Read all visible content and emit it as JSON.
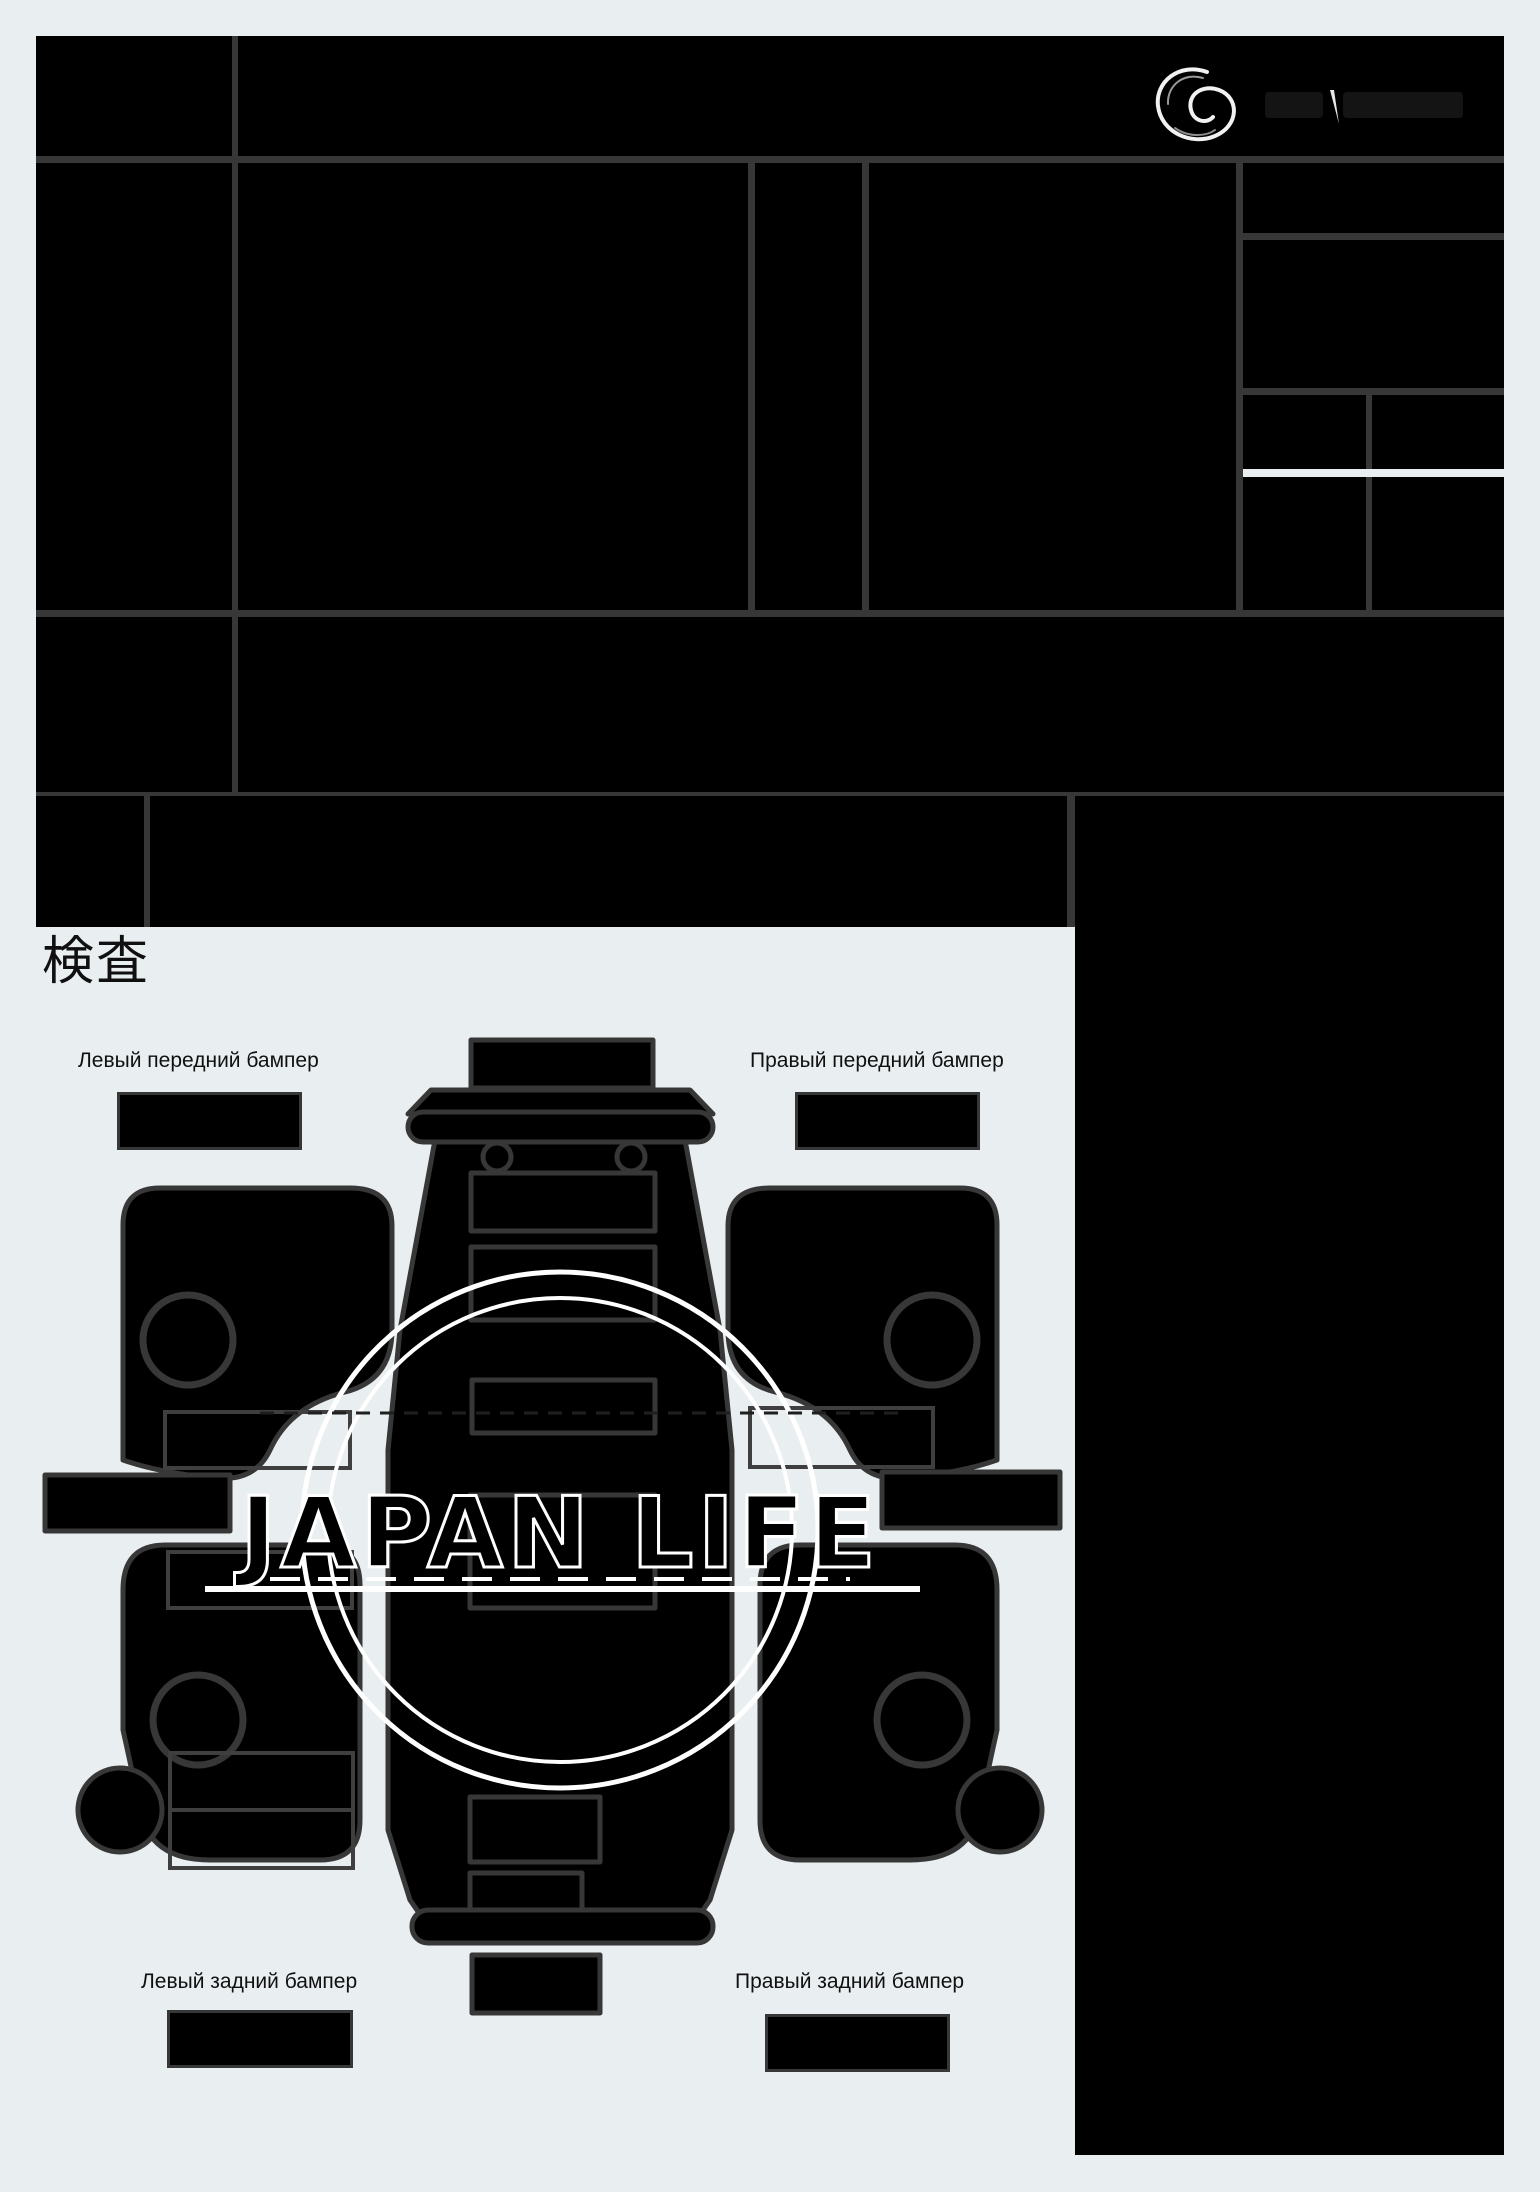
{
  "canvas": {
    "width": 1540,
    "height": 2192,
    "background": "#e9eef1",
    "grid_line_color": "#373737",
    "redaction_color": "#000000",
    "stamp_color": "#ffffff"
  },
  "header": {
    "logo_name": "g-swirl-logo"
  },
  "inspection": {
    "heading": "検査"
  },
  "diagram": {
    "stamp_text": "JAPAN LIFE",
    "labels": {
      "front_left": "Левый передний бампер",
      "front_right": "Правый передний бампер",
      "rear_left": "Левый задний бампер",
      "rear_right": "Правый задний бампер"
    }
  }
}
